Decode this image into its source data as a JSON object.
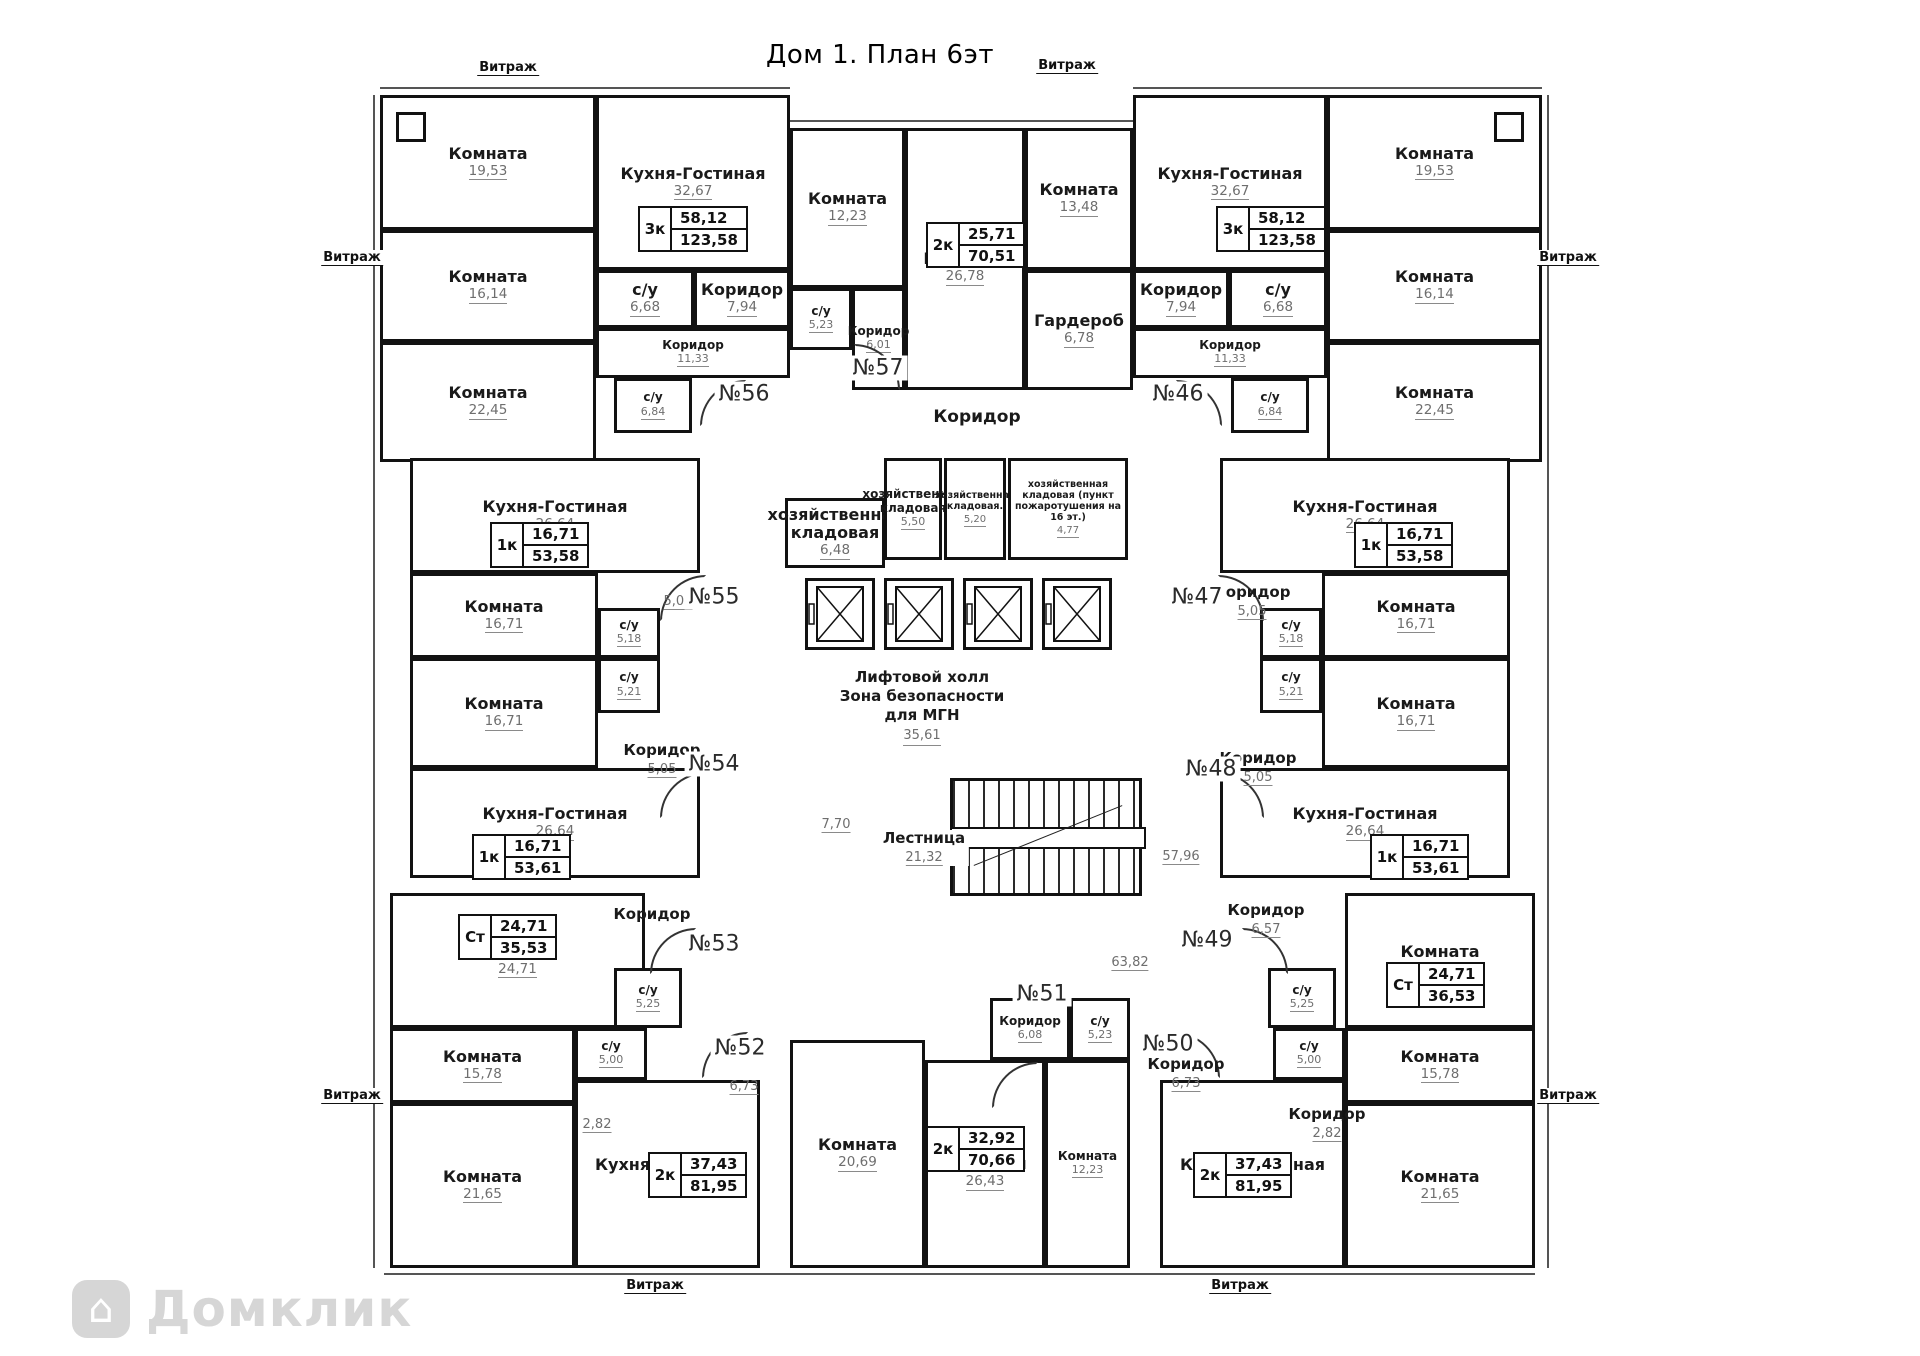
{
  "title": "Дом 1. План 6эт",
  "vitrage_label": "Витраж",
  "watermark": {
    "text": "Домклик"
  },
  "lift_hall": {
    "line1": "Лифтовой холл",
    "line2": "Зона безопасности",
    "line3": "для МГН",
    "area": "35,61"
  },
  "stairs": {
    "label": "Лестница",
    "area": "21,32"
  },
  "rooms": [
    {
      "n": "Комната",
      "a": "19,53",
      "x": 380,
      "y": 95,
      "w": 216,
      "h": 135
    },
    {
      "n": "Кухня-Гостиная",
      "a": "32,67",
      "x": 596,
      "y": 95,
      "w": 194,
      "h": 175
    },
    {
      "n": "Комната",
      "a": "16,14",
      "x": 380,
      "y": 230,
      "w": 216,
      "h": 112
    },
    {
      "n": "Комната",
      "a": "22,45",
      "x": 380,
      "y": 342,
      "w": 216,
      "h": 120
    },
    {
      "n": "с/у",
      "a": "6,68",
      "x": 596,
      "y": 270,
      "w": 98,
      "h": 58
    },
    {
      "n": "Коридор",
      "a": "7,94",
      "x": 694,
      "y": 270,
      "w": 96,
      "h": 58
    },
    {
      "n": "Коридор",
      "a": "11,33",
      "x": 596,
      "y": 328,
      "w": 194,
      "h": 50
    },
    {
      "n": "с/у",
      "a": "6,84",
      "x": 614,
      "y": 378,
      "w": 78,
      "h": 55
    },
    {
      "n": "Комната",
      "a": "12,23",
      "x": 790,
      "y": 128,
      "w": 115,
      "h": 160
    },
    {
      "n": "Кухня-Гостиная",
      "a": "26,78",
      "x": 905,
      "y": 128,
      "w": 120,
      "h": 262
    },
    {
      "n": "Комната",
      "a": "13,48",
      "x": 1025,
      "y": 128,
      "w": 108,
      "h": 142
    },
    {
      "n": "с/у",
      "a": "5,23",
      "x": 790,
      "y": 288,
      "w": 62,
      "h": 62
    },
    {
      "n": "Коридор",
      "a": "6,01",
      "x": 852,
      "y": 288,
      "w": 53,
      "h": 102
    },
    {
      "n": "Гардероб",
      "a": "6,78",
      "x": 1025,
      "y": 270,
      "w": 108,
      "h": 120
    },
    {
      "n": "Кухня-Гостиная",
      "a": "32,67",
      "x": 1133,
      "y": 95,
      "w": 194,
      "h": 175
    },
    {
      "n": "Комната",
      "a": "19,53",
      "x": 1327,
      "y": 95,
      "w": 215,
      "h": 135
    },
    {
      "n": "Комната",
      "a": "16,14",
      "x": 1327,
      "y": 230,
      "w": 215,
      "h": 112
    },
    {
      "n": "Комната",
      "a": "22,45",
      "x": 1327,
      "y": 342,
      "w": 215,
      "h": 120
    },
    {
      "n": "Коридор",
      "a": "7,94",
      "x": 1133,
      "y": 270,
      "w": 96,
      "h": 58
    },
    {
      "n": "с/у",
      "a": "6,68",
      "x": 1229,
      "y": 270,
      "w": 98,
      "h": 58
    },
    {
      "n": "Коридор",
      "a": "11,33",
      "x": 1133,
      "y": 328,
      "w": 194,
      "h": 50
    },
    {
      "n": "с/у",
      "a": "6,84",
      "x": 1231,
      "y": 378,
      "w": 78,
      "h": 55
    },
    {
      "n": "Кухня-Гостиная",
      "a": "26,64",
      "x": 410,
      "y": 458,
      "w": 290,
      "h": 115
    },
    {
      "n": "Комната",
      "a": "16,71",
      "x": 410,
      "y": 573,
      "w": 188,
      "h": 85
    },
    {
      "n": "с/у",
      "a": "5,18",
      "x": 598,
      "y": 608,
      "w": 62,
      "h": 50
    },
    {
      "n": "Комната",
      "a": "16,71",
      "x": 410,
      "y": 658,
      "w": 188,
      "h": 110
    },
    {
      "n": "с/у",
      "a": "5,21",
      "x": 598,
      "y": 658,
      "w": 62,
      "h": 55
    },
    {
      "n": "Кухня-Гостиная",
      "a": "26,64",
      "x": 410,
      "y": 768,
      "w": 290,
      "h": 110
    },
    {
      "n": "Кухня-Гостиная",
      "a": "26,64",
      "x": 1220,
      "y": 458,
      "w": 290,
      "h": 115
    },
    {
      "n": "Комната",
      "a": "16,71",
      "x": 1322,
      "y": 573,
      "w": 188,
      "h": 85
    },
    {
      "n": "с/у",
      "a": "5,18",
      "x": 1260,
      "y": 608,
      "w": 62,
      "h": 50
    },
    {
      "n": "Комната",
      "a": "16,71",
      "x": 1322,
      "y": 658,
      "w": 188,
      "h": 110
    },
    {
      "n": "с/у",
      "a": "5,21",
      "x": 1260,
      "y": 658,
      "w": 62,
      "h": 55
    },
    {
      "n": "Кухня-Гостиная",
      "a": "26,64",
      "x": 1220,
      "y": 768,
      "w": 290,
      "h": 110
    },
    {
      "n": "Комната",
      "a": "24,71",
      "x": 390,
      "y": 893,
      "w": 255,
      "h": 135
    },
    {
      "n": "с/у",
      "a": "5,25",
      "x": 614,
      "y": 968,
      "w": 68,
      "h": 60
    },
    {
      "n": "Комната",
      "a": "24,71",
      "x": 1345,
      "y": 893,
      "w": 190,
      "h": 135
    },
    {
      "n": "с/у",
      "a": "5,25",
      "x": 1268,
      "y": 968,
      "w": 68,
      "h": 60
    },
    {
      "n": "Комната",
      "a": "15,78",
      "x": 390,
      "y": 1028,
      "w": 185,
      "h": 75
    },
    {
      "n": "с/у",
      "a": "5,00",
      "x": 575,
      "y": 1028,
      "w": 72,
      "h": 52
    },
    {
      "n": "Кухня-Гостиная",
      "a": "29,97",
      "x": 575,
      "y": 1080,
      "w": 185,
      "h": 188
    },
    {
      "n": "Комната",
      "a": "21,65",
      "x": 390,
      "y": 1103,
      "w": 185,
      "h": 165
    },
    {
      "n": "Коридор",
      "a": "6,08",
      "x": 990,
      "y": 998,
      "w": 80,
      "h": 62
    },
    {
      "n": "с/у",
      "a": "5,23",
      "x": 1070,
      "y": 998,
      "w": 60,
      "h": 62
    },
    {
      "n": "Комната",
      "a": "20,69",
      "x": 790,
      "y": 1040,
      "w": 135,
      "h": 228
    },
    {
      "n": "Кухня-Гостиная",
      "a": "26,43",
      "x": 925,
      "y": 1060,
      "w": 120,
      "h": 208
    },
    {
      "n": "Комната",
      "a": "12,23",
      "x": 1045,
      "y": 1060,
      "w": 85,
      "h": 208
    },
    {
      "n": "с/у",
      "a": "5,00",
      "x": 1273,
      "y": 1028,
      "w": 72,
      "h": 52
    },
    {
      "n": "Комната",
      "a": "15,78",
      "x": 1345,
      "y": 1028,
      "w": 190,
      "h": 75
    },
    {
      "n": "Кухня-Гостиная",
      "a": "29,97",
      "x": 1160,
      "y": 1080,
      "w": 185,
      "h": 188
    },
    {
      "n": "Комната",
      "a": "21,65",
      "x": 1345,
      "y": 1103,
      "w": 190,
      "h": 165
    },
    {
      "n": "хозяйственная кладовая",
      "a": "6,48",
      "x": 785,
      "y": 498,
      "w": 100,
      "h": 70
    },
    {
      "n": "хозяйственная кладовая",
      "a": "5,50",
      "x": 884,
      "y": 458,
      "w": 58,
      "h": 102
    },
    {
      "n": "хозяйственная кладовая.",
      "a": "5,20",
      "x": 944,
      "y": 458,
      "w": 62,
      "h": 102
    },
    {
      "n": "хозяйственная кладовая (пункт пожаротушения на 16 эт.)",
      "a": "4,77",
      "x": 1008,
      "y": 458,
      "w": 120,
      "h": 102
    }
  ],
  "floats": [
    {
      "t": "Коридор",
      "a": "",
      "x": 977,
      "y": 408,
      "big": true
    },
    {
      "t": "",
      "a": "7,70",
      "x": 836,
      "y": 814
    },
    {
      "t": "",
      "a": "57,96",
      "x": 1181,
      "y": 846
    },
    {
      "t": "",
      "a": "63,82",
      "x": 1130,
      "y": 952,
      "bg": true
    },
    {
      "t": "",
      "a": "5,05",
      "x": 678,
      "y": 591
    },
    {
      "t": "Коридор",
      "a": "5,05",
      "x": 662,
      "y": 742
    },
    {
      "t": "Коридор",
      "a": "5,05",
      "x": 1252,
      "y": 584
    },
    {
      "t": "Коридор",
      "a": "5,05",
      "x": 1258,
      "y": 750
    },
    {
      "t": "Коридор",
      "a": "",
      "x": 652,
      "y": 906
    },
    {
      "t": "Коридор",
      "a": "6,57",
      "x": 1266,
      "y": 902
    },
    {
      "t": "",
      "a": "2,82",
      "x": 597,
      "y": 1114
    },
    {
      "t": "",
      "a": "6,73",
      "x": 744,
      "y": 1076
    },
    {
      "t": "Коридор",
      "a": "6,73",
      "x": 1186,
      "y": 1056
    },
    {
      "t": "Коридор",
      "a": "2,82",
      "x": 1327,
      "y": 1106
    },
    {
      "t": "Лестница",
      "a": "21,32",
      "x": 924,
      "y": 830,
      "bg": true
    }
  ],
  "units": [
    {
      "label": "№56",
      "x": 744,
      "y": 394
    },
    {
      "label": "№57",
      "x": 878,
      "y": 368
    },
    {
      "label": "№46",
      "x": 1178,
      "y": 394
    },
    {
      "label": "№55",
      "x": 714,
      "y": 597
    },
    {
      "label": "№47",
      "x": 1197,
      "y": 597
    },
    {
      "label": "№54",
      "x": 714,
      "y": 764
    },
    {
      "label": "№48",
      "x": 1211,
      "y": 769
    },
    {
      "label": "№53",
      "x": 714,
      "y": 944
    },
    {
      "label": "№49",
      "x": 1207,
      "y": 940
    },
    {
      "label": "№52",
      "x": 740,
      "y": 1048
    },
    {
      "label": "№51",
      "x": 1042,
      "y": 994
    },
    {
      "label": "№50",
      "x": 1168,
      "y": 1044
    }
  ],
  "tables": [
    {
      "type": "3к",
      "a1": "58,12",
      "a2": "123,58",
      "x": 638,
      "y": 206
    },
    {
      "type": "2к",
      "a1": "25,71",
      "a2": "70,51",
      "x": 926,
      "y": 222
    },
    {
      "type": "3к",
      "a1": "58,12",
      "a2": "123,58",
      "x": 1216,
      "y": 206
    },
    {
      "type": "1к",
      "a1": "16,71",
      "a2": "53,58",
      "x": 490,
      "y": 522
    },
    {
      "type": "1к",
      "a1": "16,71",
      "a2": "53,58",
      "x": 1354,
      "y": 522
    },
    {
      "type": "1к",
      "a1": "16,71",
      "a2": "53,61",
      "x": 472,
      "y": 834
    },
    {
      "type": "1к",
      "a1": "16,71",
      "a2": "53,61",
      "x": 1370,
      "y": 834
    },
    {
      "type": "Ст",
      "a1": "24,71",
      "a2": "35,53",
      "x": 458,
      "y": 914
    },
    {
      "type": "Ст",
      "a1": "24,71",
      "a2": "36,53",
      "x": 1386,
      "y": 962
    },
    {
      "type": "2к",
      "a1": "37,43",
      "a2": "81,95",
      "x": 648,
      "y": 1152
    },
    {
      "type": "2к",
      "a1": "37,43",
      "a2": "81,95",
      "x": 1193,
      "y": 1152
    },
    {
      "type": "2к",
      "a1": "32,92",
      "a2": "70,66",
      "x": 926,
      "y": 1126
    }
  ],
  "vitrage_positions": [
    {
      "x": 508,
      "y": 60
    },
    {
      "x": 1067,
      "y": 58
    },
    {
      "x": 352,
      "y": 250
    },
    {
      "x": 1568,
      "y": 250
    },
    {
      "x": 352,
      "y": 1088
    },
    {
      "x": 1568,
      "y": 1088
    },
    {
      "x": 655,
      "y": 1278
    },
    {
      "x": 1240,
      "y": 1278
    }
  ],
  "doors": [
    {
      "x": 700,
      "y": 380,
      "r": 0
    },
    {
      "x": 854,
      "y": 344,
      "r": 90
    },
    {
      "x": 1176,
      "y": 380,
      "r": 90
    },
    {
      "x": 660,
      "y": 575,
      "r": 0
    },
    {
      "x": 660,
      "y": 772,
      "r": 0
    },
    {
      "x": 1218,
      "y": 575,
      "r": 90
    },
    {
      "x": 1218,
      "y": 772,
      "r": 90
    },
    {
      "x": 650,
      "y": 928,
      "r": 0
    },
    {
      "x": 1242,
      "y": 928,
      "r": 90
    },
    {
      "x": 702,
      "y": 1032,
      "r": 0
    },
    {
      "x": 1174,
      "y": 1032,
      "r": 90
    },
    {
      "x": 992,
      "y": 1062,
      "r": 0
    }
  ],
  "markers": [
    {
      "x": 396,
      "y": 112
    },
    {
      "x": 1494,
      "y": 112
    }
  ],
  "elevator_count": 4
}
